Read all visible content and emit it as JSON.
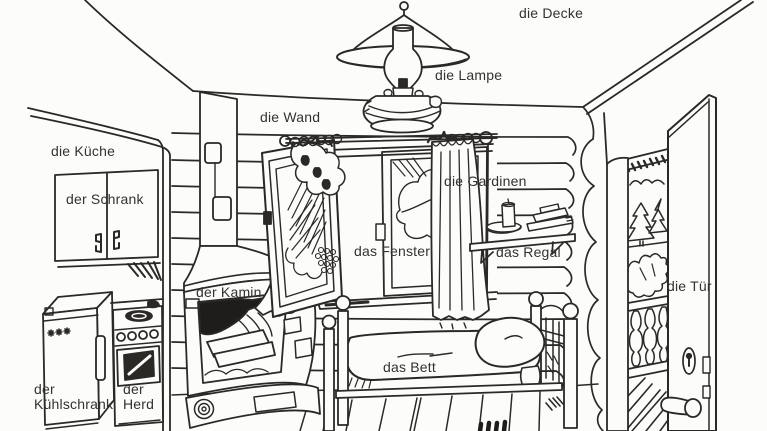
{
  "illustration": {
    "description_labels_language": "de",
    "colors": {
      "ink": "#2b2926",
      "paper": "#fcfcfa"
    }
  },
  "labels": {
    "decke": "die Decke",
    "lampe": "die Lampe",
    "wand": "die Wand",
    "kueche": "die Küche",
    "schrank": "der Schrank",
    "gardinen": "die Gardinen",
    "fenster": "das Fenster",
    "regal": "das Regal",
    "kamin": "der Kamin",
    "tuer": "die Tür",
    "bett": "das Bett",
    "kuehlschrank_line1": "der",
    "kuehlschrank_line2": "Kühlschrank",
    "herd_line1": "der",
    "herd_line2": "Herd"
  }
}
